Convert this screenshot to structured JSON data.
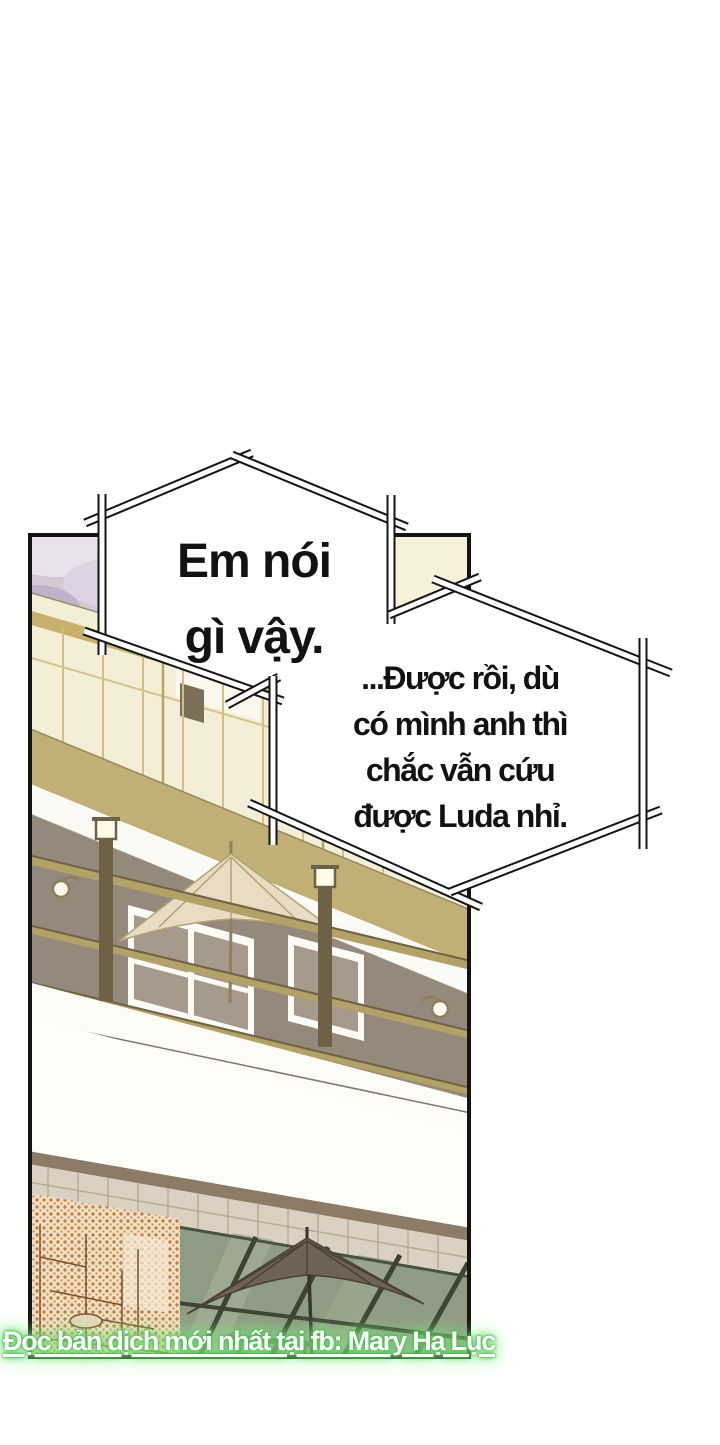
{
  "comic": {
    "bubble1": {
      "lines": [
        "Em nói",
        "gì vậy."
      ]
    },
    "bubble2": {
      "lines": [
        "...Được rồi, dù",
        "có mình anh thì",
        "chắc vẫn cứu",
        "được Luda nhỉ."
      ]
    },
    "watermark": {
      "text": "Đọc bản dịch mới nhất tại fb: Mary Hạ Lục"
    },
    "colors": {
      "page_bg": "#ffffff",
      "ink": "#141414",
      "sky_lavender": "#d4c9d6",
      "building_cream": "#f5eed7",
      "band_tan": "#c1b075",
      "balcony_taupe": "#95897b",
      "umbrella_cream": "#e8ddc3",
      "umbrella_dark": "#6e6254",
      "glass_sage": "#8f9c85",
      "screentone_orange": "#c8823e",
      "brick": "#dad1c2",
      "watermark_text": "#ffffff",
      "watermark_glow": "#63dd66"
    }
  }
}
